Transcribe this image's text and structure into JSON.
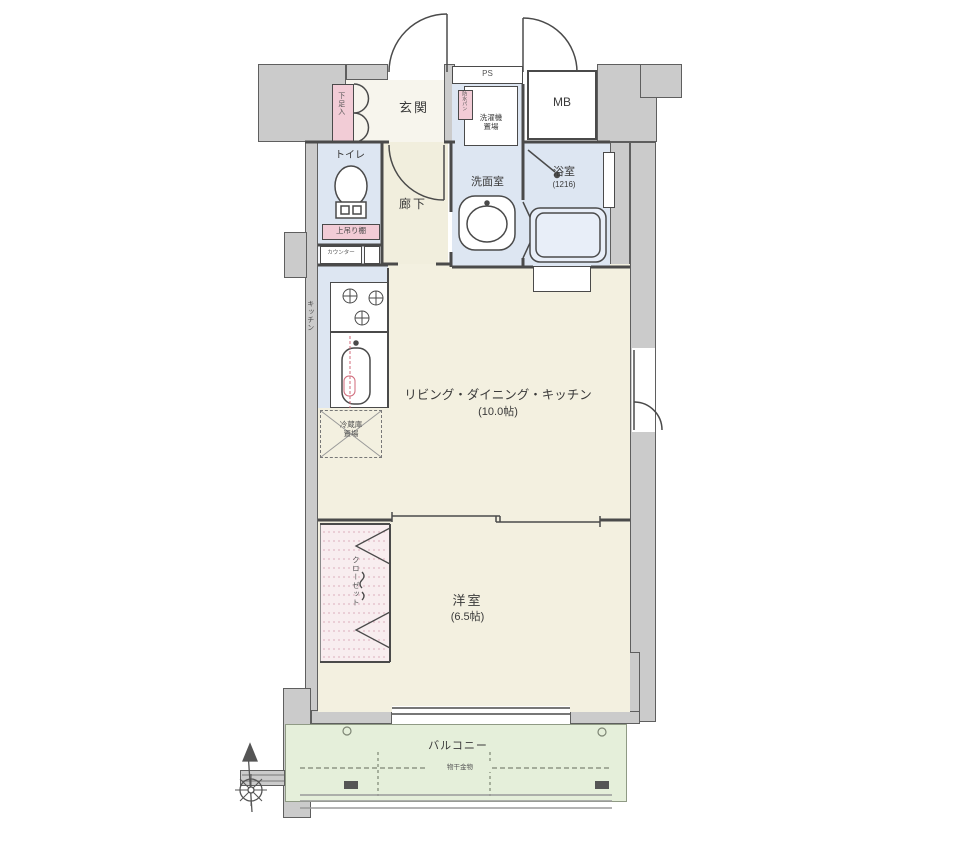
{
  "title": "マンション間取り図",
  "colors": {
    "floor_beige": "#f3f0e0",
    "wet_blue": "#dde6f2",
    "balcony_green": "#e5efda",
    "closet_pink": "#f8edef",
    "tag_pink": "#f2ccd6",
    "wall_gray": "#cbcbcb"
  },
  "rooms": {
    "genkan": {
      "label": "玄関",
      "shoe": "下足入"
    },
    "mb": {
      "label": "MB"
    },
    "ps": {
      "label": "PS"
    },
    "senmen": {
      "label": "洗面室",
      "tag": "防水パン",
      "washer": {
        "line1": "洗濯機",
        "line2": "置場"
      }
    },
    "bath": {
      "label": "浴室",
      "size": "(1216)"
    },
    "toilet": {
      "label": "トイレ",
      "shelf": "上吊り棚",
      "counter": "カウンター"
    },
    "hallway": {
      "label": "廊下"
    },
    "kitchen": {
      "label": "キッチン",
      "fridge": {
        "line1": "冷蔵庫",
        "line2": "置場"
      }
    },
    "ldk": {
      "label": "リビング・ダイニング・キッチン",
      "size": "(10.0帖)"
    },
    "bedroom": {
      "label": "洋室",
      "size": "(6.5帖)",
      "closet": "クローゼット"
    },
    "balcony": {
      "label": "バルコニー",
      "hardware": "物干金物"
    }
  }
}
